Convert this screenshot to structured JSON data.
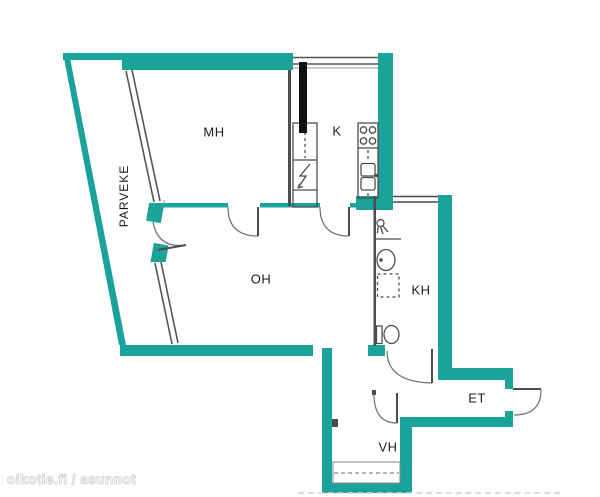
{
  "plan_type": "apartment-floor-plan",
  "colors": {
    "wall": "#1AA39B",
    "partition": "#4d4d4d",
    "door": "#6e6e6e",
    "fixture": "#4d4d4d",
    "flue": "#111111",
    "label": "#1c1c1c",
    "watermark": "#d9d9d9",
    "background": "#ffffff"
  },
  "rooms": {
    "balcony": {
      "label": "PARVEKE"
    },
    "bedroom": {
      "label": "MH"
    },
    "kitchen": {
      "label": "K"
    },
    "living": {
      "label": "OH"
    },
    "bathroom": {
      "label": "KH"
    },
    "entry": {
      "label": "ET"
    },
    "closet": {
      "label": "VH"
    }
  },
  "fixtures": [
    "stove-icon",
    "sink-icon",
    "flue-bar",
    "electrical-panel-icon",
    "shower-icon",
    "washbasin-icon",
    "washer-space",
    "toilet-icon",
    "wardrobe-rail"
  ],
  "watermark": {
    "text": "oikotie.fi / asunnot"
  }
}
